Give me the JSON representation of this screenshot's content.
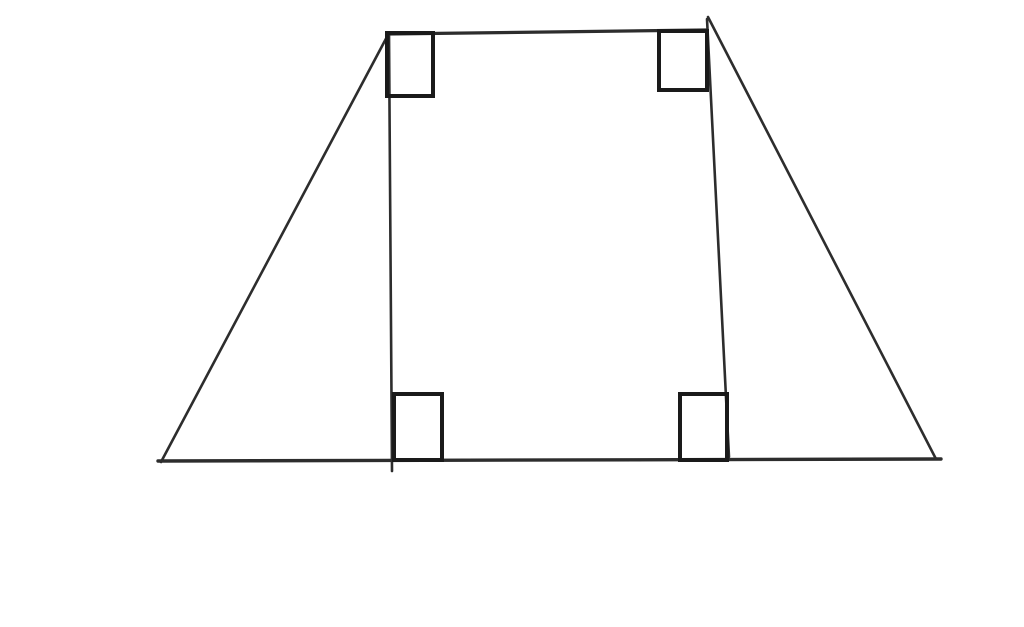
{
  "figure": {
    "type": "geometry-diagram",
    "description": "Trapezoid with two altitudes dropped from the top vertices to the base forming an inner rectangle; right-angle square markers at the four corners of the rectangle",
    "canvas": {
      "width": 1024,
      "height": 627,
      "background": "#ffffff"
    },
    "stroke": {
      "line_color": "#2d2d2d",
      "marker_color": "#1a1a1a",
      "marker_width": 4
    },
    "lines": [
      {
        "name": "trapezoid-base",
        "x1": 158,
        "y1": 461,
        "x2": 941,
        "y2": 459,
        "width": 3.4
      },
      {
        "name": "trapezoid-left-leg",
        "x1": 161,
        "y1": 462,
        "x2": 389,
        "y2": 33,
        "width": 2.6
      },
      {
        "name": "trapezoid-top-side",
        "x1": 387,
        "y1": 34,
        "x2": 706,
        "y2": 30,
        "width": 3.2
      },
      {
        "name": "trapezoid-right-leg",
        "x1": 708,
        "y1": 17,
        "x2": 936,
        "y2": 459,
        "width": 2.6
      },
      {
        "name": "left-altitude",
        "x1": 389,
        "y1": 33,
        "x2": 392,
        "y2": 471,
        "width": 2.6
      },
      {
        "name": "right-altitude",
        "x1": 707,
        "y1": 19,
        "x2": 729,
        "y2": 457,
        "width": 2.6
      }
    ],
    "right_angle_markers": [
      {
        "name": "top-left",
        "x": 387,
        "y": 33,
        "w": 46,
        "h": 63
      },
      {
        "name": "top-right",
        "x": 659,
        "y": 31,
        "w": 48,
        "h": 59
      },
      {
        "name": "bottom-left",
        "x": 394,
        "y": 394,
        "w": 48,
        "h": 66
      },
      {
        "name": "bottom-right",
        "x": 680,
        "y": 394,
        "w": 47,
        "h": 66
      }
    ]
  }
}
